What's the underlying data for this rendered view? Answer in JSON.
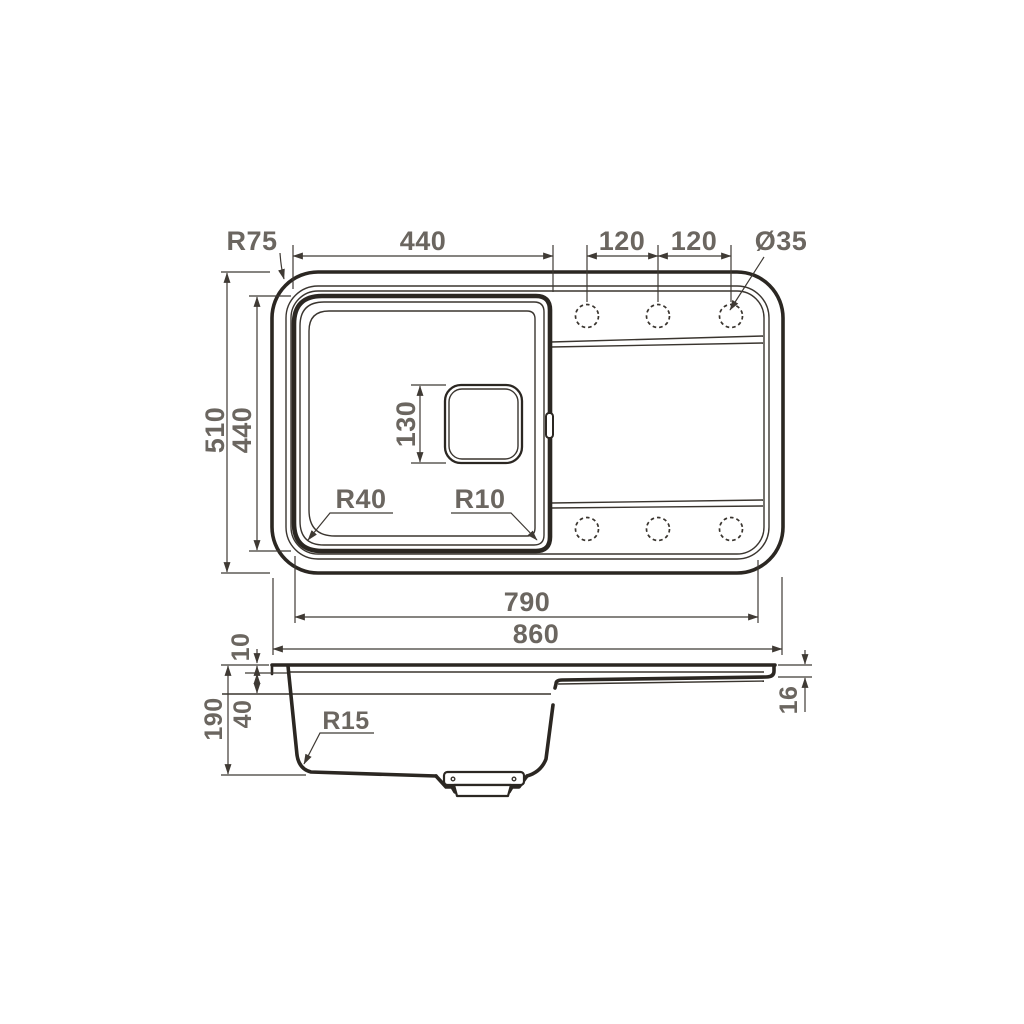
{
  "drawing": {
    "description": "Kitchen sink dimensional technical drawing, top view and side section view",
    "colors": {
      "background": "#ffffff",
      "line": "#2b2722",
      "dimension_line": "#3f3a34",
      "label_text": "#6b6660"
    },
    "top_view": {
      "corner_radius": "R75",
      "bowl_width": "440",
      "tap_hole_spacing_1": "120",
      "tap_hole_spacing_2": "120",
      "tap_hole_diameter": "Ø35",
      "overall_depth": "510",
      "bowl_depth": "440",
      "drain_hole_size": "130",
      "bowl_floor_radius": "R40",
      "bowl_edge_radius": "R10",
      "inner_length": "790",
      "overall_length": "860"
    },
    "side_view": {
      "rim_thickness": "10",
      "overall_height": "190",
      "upper_ledge_depth": "40",
      "bottom_corner_radius": "R15",
      "drainer_edge_thickness": "16"
    }
  }
}
